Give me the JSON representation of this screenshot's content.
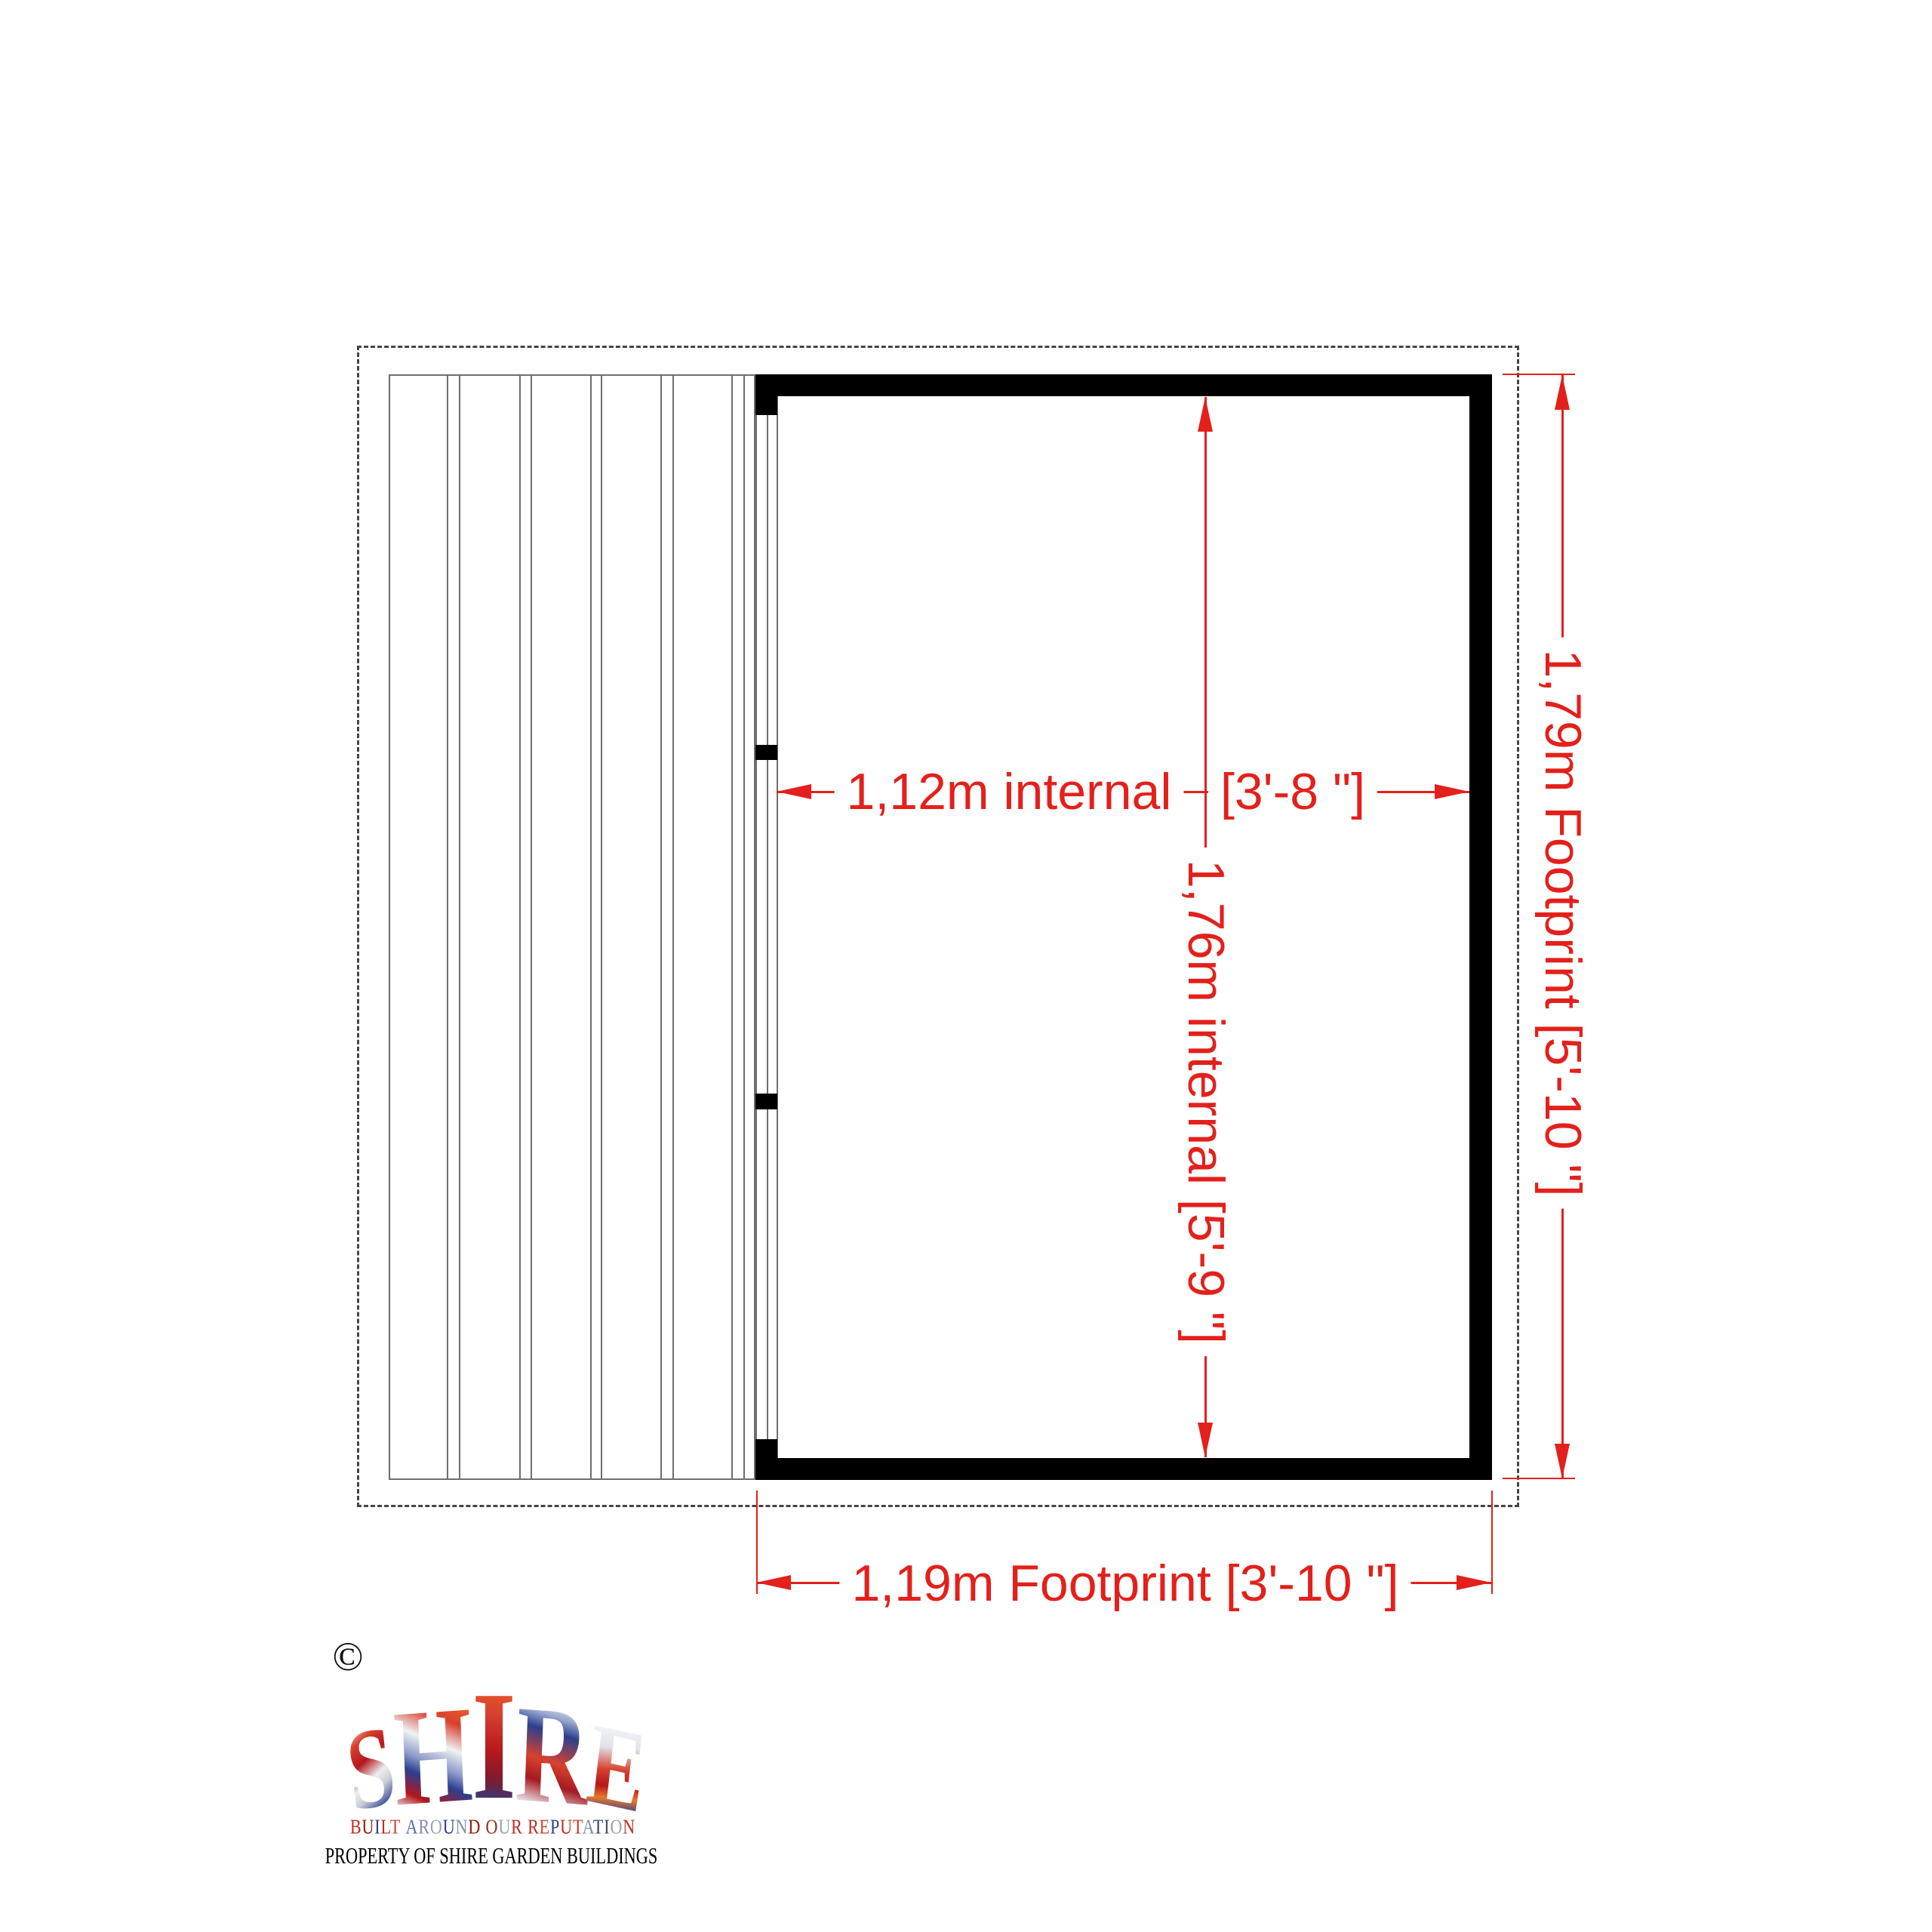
{
  "document_type": "shed floor plan drawing",
  "dimensions": {
    "internal_width_metric": "1,12m internal",
    "internal_width_imperial": "[3'-8 \"]",
    "internal_depth": "1,76m internal  [5'-9 \"]",
    "footprint_depth": "1,79m Footprint [5'-10 \"]",
    "footprint_width": "1,19m Footprint [3'-10 \"]"
  },
  "logo": {
    "copyright_symbol": "©",
    "brand_letters": [
      "S",
      "H",
      "I",
      "R",
      "E"
    ],
    "tagline": {
      "text": "BUILT AROUND OUR REPUTATION",
      "letter_colors": [
        "#bf2b1e",
        "#8e1a10",
        "#2e3f86",
        "#bf2b1e",
        "#d24331",
        "#5d6fa3",
        "#7f8db1",
        "#99a1ae",
        "#2e3f86",
        "#7f8db1",
        "#8e1a10",
        "#93301f",
        "#99a1ae",
        "#bf2b1e",
        "#bf2b1e",
        "#d24331",
        "#2e3f86",
        "#bf2b1e",
        "#c33a24",
        "#7f8db1",
        "#2e3f86",
        "#434a63",
        "#99a1ae",
        "#bf2b1e"
      ]
    },
    "property_line": "PROPERTY OF SHIRE GARDEN BUILDINGS"
  },
  "colors": {
    "dimension_red": "#e3201b",
    "wall_black": "#000000",
    "thin_line_gray": "#6e6e6e",
    "dashed_gray": "#454545",
    "background": "#ffffff"
  }
}
